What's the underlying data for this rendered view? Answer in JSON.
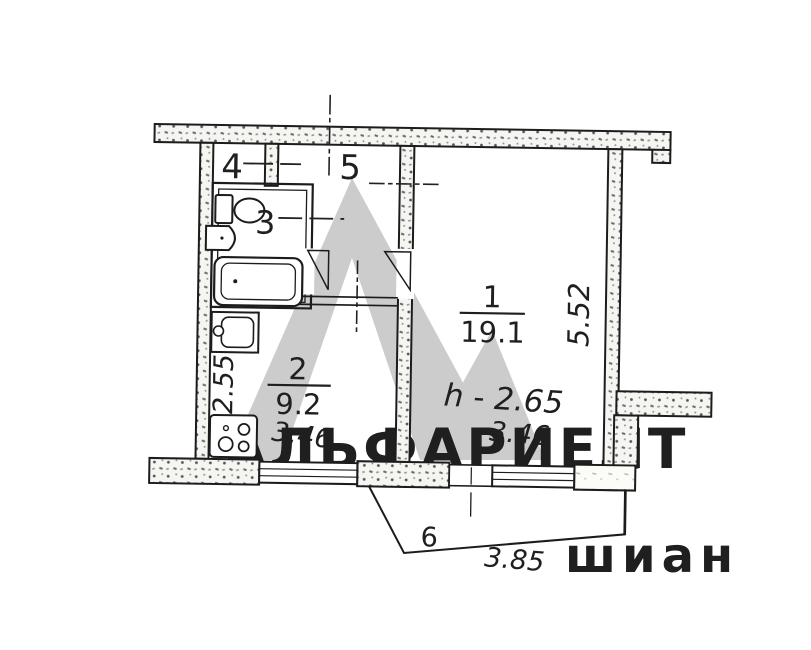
{
  "watermark": {
    "brand": "АЛЬФАРИЕЛТ",
    "faint_text": "шиан",
    "logo_color": "#cccccc",
    "text_color": "#c7c7c7"
  },
  "plan": {
    "rooms": [
      {
        "number": "1",
        "area": "19.1"
      },
      {
        "number": "2",
        "area": "9.2"
      },
      {
        "number": "3"
      },
      {
        "number": "4"
      },
      {
        "number": "5"
      },
      {
        "number": "6"
      }
    ],
    "dimensions": {
      "right_side": "5.52",
      "kitchen_left": "2.55",
      "kitchen_width": "3.46",
      "room1_width": "3.46",
      "balcony_width": "3.85",
      "ceiling_height": "h - 2.65"
    },
    "colors": {
      "line": "#1f1f1f",
      "background": "#ffffff"
    }
  }
}
